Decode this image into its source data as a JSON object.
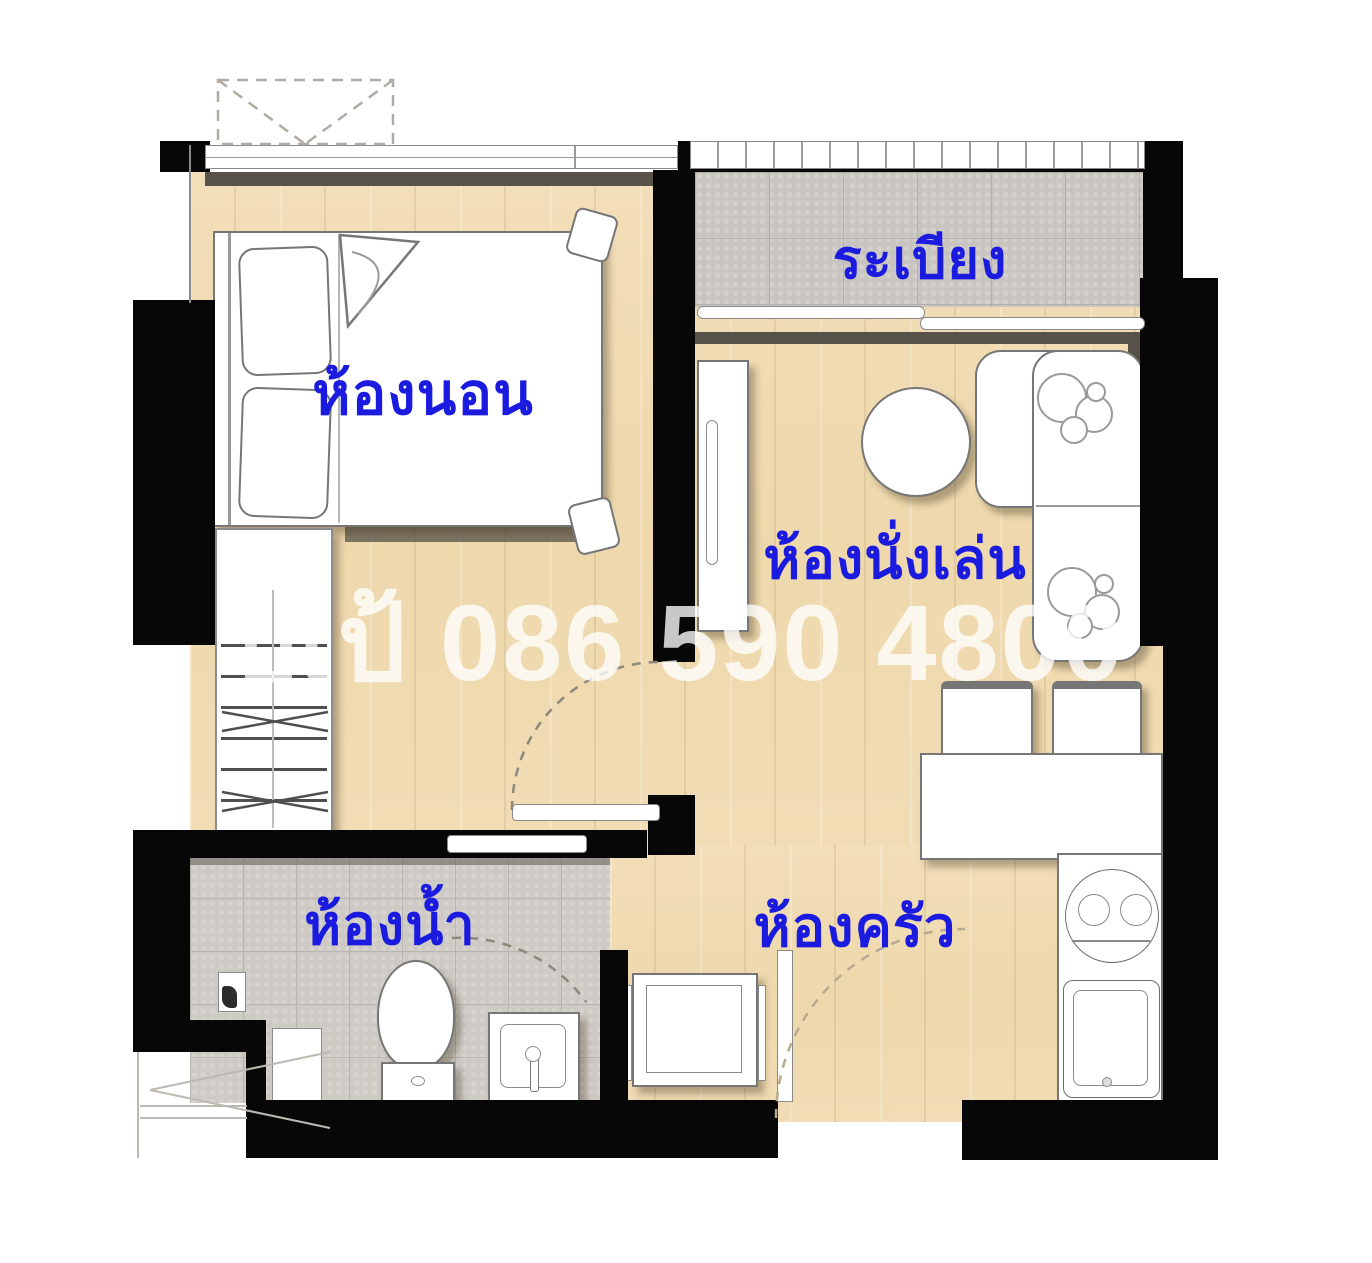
{
  "plan": {
    "type": "apartment-floor-plan",
    "watermark": "ปเป้ 086 590 4800",
    "rooms": {
      "balcony": {
        "label": "ระเบียง"
      },
      "bedroom": {
        "label": "ห้องนอน"
      },
      "living": {
        "label": "ห้องนั่งเล่น"
      },
      "bathroom": {
        "label": "ห้องน้ำ"
      },
      "kitchen": {
        "label": "ห้องครัว"
      }
    },
    "colors": {
      "label_blue": "#1b1be0",
      "wood_floor": "#f0dcb4",
      "balcony_tile": "#c8c4bf",
      "bathroom_tile": "#cdc9c4",
      "wall_black": "#070707",
      "watermark_white": "rgba(255,255,255,0.78)"
    }
  }
}
